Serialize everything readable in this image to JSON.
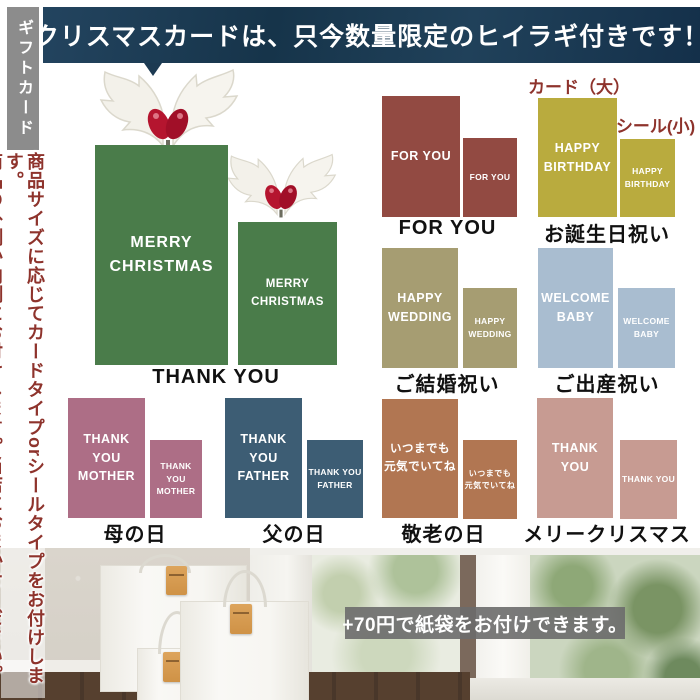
{
  "banner": {
    "title": "クリスマスカードは、只今数量限定のヒイラギ付きです！"
  },
  "sidebar": {
    "tab_label": "ギフトカード",
    "note_line1": "商品サイズに応じてカードタイプorシールタイプをお付けします。",
    "note_line2": "商品の外側か内側にお付けします。当店におまかせください。"
  },
  "size_labels": {
    "card_large": "カード（大）",
    "seal_small": "シール(小)"
  },
  "groups": [
    {
      "id": "christmas-green",
      "caption": "THANK YOU",
      "big_text": "MERRY\nCHRISTMAS",
      "small_text": "MERRY\nCHRISTMAS",
      "color": "#4a7c4a"
    },
    {
      "id": "for-you",
      "caption": "FOR YOU",
      "big_text": "FOR YOU",
      "small_text": "FOR YOU",
      "color": "#924a42"
    },
    {
      "id": "birthday",
      "caption": "お誕生日祝い",
      "big_text": "HAPPY\nBIRTHDAY",
      "small_text": "HAPPY\nBIRTHDAY",
      "color": "#b9ab3e"
    },
    {
      "id": "wedding",
      "caption": "ご結婚祝い",
      "big_text": "HAPPY\nWEDDING",
      "small_text": "HAPPY\nWEDDING",
      "color": "#a69d72"
    },
    {
      "id": "baby",
      "caption": "ご出産祝い",
      "big_text": "WELCOME\nBABY",
      "small_text": "WELCOME\nBABY",
      "color": "#a9bdd0"
    },
    {
      "id": "mothers-day",
      "caption": "母の日",
      "big_text": "THANK YOU\nMOTHER",
      "small_text": "THANK YOU\nMOTHER",
      "color": "#ad6e86"
    },
    {
      "id": "fathers-day",
      "caption": "父の日",
      "big_text": "THANK YOU\nFATHER",
      "small_text": "THANK YOU\nFATHER",
      "color": "#3d5d74"
    },
    {
      "id": "respect-for-aged",
      "caption": "敬老の日",
      "big_text": "いつまでも\n元気でいてね",
      "small_text": "いつまでも\n元気でいてね",
      "color": "#b17652"
    },
    {
      "id": "merry-christmas",
      "caption": "メリークリスマス",
      "big_text": "THANK YOU",
      "small_text": "THANK YOU",
      "color": "#c79b92"
    }
  ],
  "footer": {
    "paper_bag_note": "+70円で紙袋をお付けできます。"
  },
  "colors": {
    "banner_bg": "#1c3a52",
    "sidebar_tab_bg": "#8c8c8c",
    "accent_red_text": "#8e332c",
    "holly_berry": "#b5152f"
  }
}
